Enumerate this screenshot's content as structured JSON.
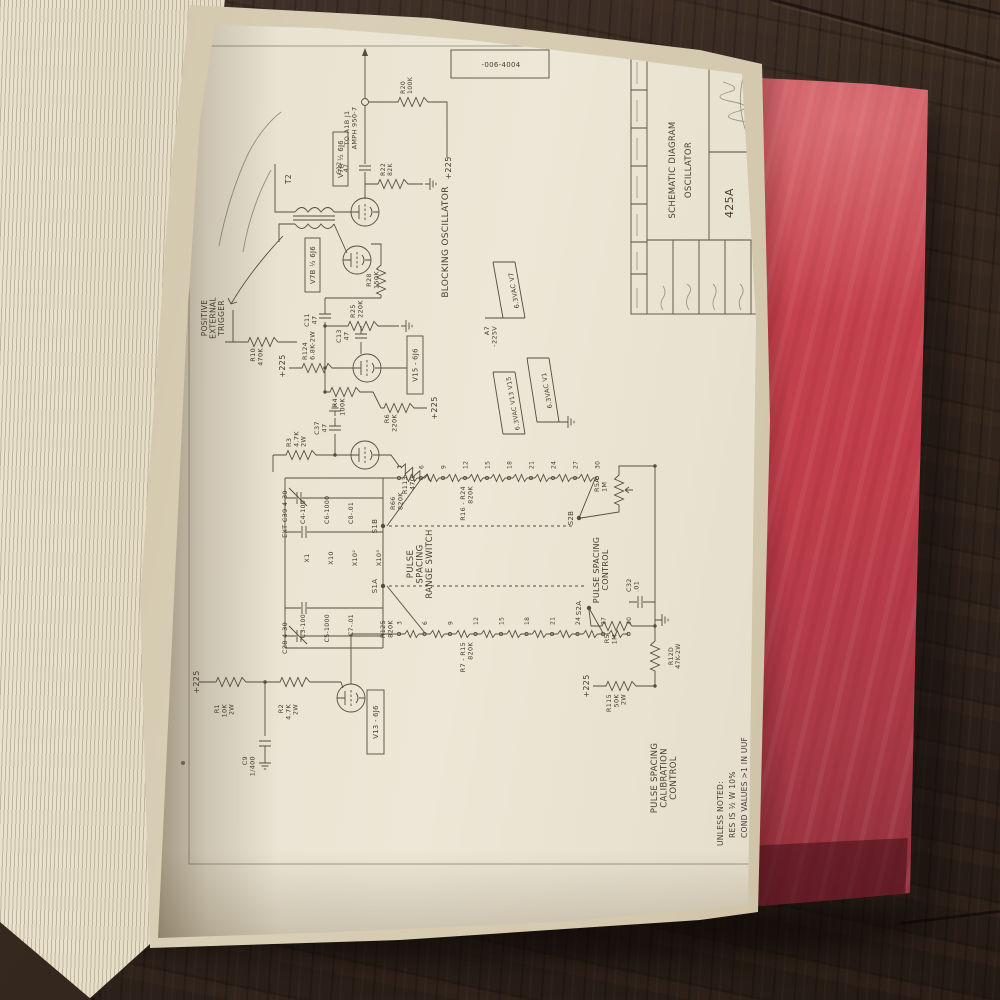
{
  "colors": {
    "cover_red": "#c2414d",
    "page_cream": "#e9e3d2",
    "wood_brown": "#33271e",
    "ink": "#554d40"
  },
  "schematic": {
    "part_number": "-006-4004",
    "title_block": {
      "title_line1": "SCHEMATIC DIAGRAM",
      "title_line2": "OSCILLATOR",
      "model": "425A"
    },
    "notes": [
      "UNLESS NOTED:",
      "RES IS ½ W 10%",
      "COND VALUES >1 IN UUF",
      "COND VALUES <1 IN UF",
      "SEE 425A SOURCE"
    ],
    "range_switch": {
      "contacts": [
        "3",
        "6",
        "9",
        "12",
        "15",
        "18",
        "21",
        "24",
        "27",
        "30"
      ]
    },
    "boxes": [
      {
        "t": "V13 - 6J6",
        "x": 116,
        "y": 182,
        "w": 64,
        "h": 17
      },
      {
        "t": "V15 - 6J6",
        "x": 476,
        "y": 222,
        "w": 58,
        "h": 16
      },
      {
        "t": "V7A ½ 6J6",
        "x": 684,
        "y": 148,
        "w": 54,
        "h": 15
      },
      {
        "t": "V7B ½ 6J6",
        "x": 578,
        "y": 120,
        "w": 54,
        "h": 15
      }
    ],
    "labels": [
      {
        "t": "+225",
        "x": 188,
        "y": 14,
        "s": 8,
        "a": "middle"
      },
      {
        "t": "R1|10K|2W",
        "x": 166,
        "y": 34,
        "s": 6.5,
        "a": "end"
      },
      {
        "t": "R2|4.7K|2W",
        "x": 166,
        "y": 98,
        "s": 6.5,
        "a": "end"
      },
      {
        "t": "C9|1/400",
        "x": 114,
        "y": 62,
        "s": 6.5,
        "a": "end"
      },
      {
        "t": "POSITIVE|EXTERNAL|TRIGGER",
        "x": 552,
        "y": 22,
        "s": 7.5,
        "a": "middle"
      },
      {
        "t": "R10|470K",
        "x": 522,
        "y": 70,
        "s": 6.5,
        "a": "end"
      },
      {
        "t": "+225",
        "x": 504,
        "y": 100,
        "s": 8,
        "a": "middle"
      },
      {
        "t": "R124|6.8K-2W",
        "x": 510,
        "y": 122,
        "s": 6.5
      },
      {
        "t": "C11|47",
        "x": 550,
        "y": 124,
        "s": 6.5,
        "a": "middle"
      },
      {
        "t": "R4|100K",
        "x": 472,
        "y": 152,
        "s": 6.5,
        "a": "end"
      },
      {
        "t": "C13|47",
        "x": 534,
        "y": 156,
        "s": 6.5,
        "a": "middle"
      },
      {
        "t": "R25|220K",
        "x": 552,
        "y": 170,
        "s": 6.5
      },
      {
        "t": "R28|150K",
        "x": 590,
        "y": 186,
        "s": 6.5,
        "a": "middle"
      },
      {
        "t": "R6|220K",
        "x": 456,
        "y": 204,
        "s": 6.5,
        "a": "end"
      },
      {
        "t": "+225",
        "x": 462,
        "y": 252,
        "s": 8,
        "a": "middle"
      },
      {
        "t": "R3|4.7K|2W",
        "x": 423,
        "y": 106,
        "s": 6.5
      },
      {
        "t": "C37|47",
        "x": 442,
        "y": 134,
        "s": 6.5,
        "a": "middle"
      },
      {
        "t": "R113|47Ω",
        "x": 394,
        "y": 222,
        "s": 6.5,
        "a": "end"
      },
      {
        "t": "T2",
        "x": 686,
        "y": 106,
        "s": 7.5
      },
      {
        "t": "+225",
        "x": 702,
        "y": 266,
        "s": 8,
        "a": "middle"
      },
      {
        "t": "C12|47",
        "x": 702,
        "y": 156,
        "s": 6.2,
        "a": "middle"
      },
      {
        "t": "R22|82K",
        "x": 694,
        "y": 200,
        "s": 6.2
      },
      {
        "t": "R20|100K",
        "x": 776,
        "y": 220,
        "s": 6.2
      },
      {
        "t": "TO A1B J1|AMPH 950-7",
        "x": 742,
        "y": 164,
        "s": 6.5,
        "a": "middle"
      },
      {
        "t": "BLOCKING  OSCILLATOR",
        "x": 628,
        "y": 263,
        "s": 9,
        "a": "middle",
        "ls": 1.5
      },
      {
        "t": "A7|-225V",
        "x": 544,
        "y": 304,
        "s": 6.5,
        "a": "end"
      },
      {
        "t": "6.3VAC  V7",
        "x": 580,
        "y": 331,
        "s": 6.5,
        "a": "middle",
        "r": -10
      },
      {
        "t": "6.3VAC  V13  V15",
        "x": 467,
        "y": 330,
        "s": 6.2,
        "a": "middle",
        "r": -10
      },
      {
        "t": "6.3VAC  V1",
        "x": 480,
        "y": 364,
        "s": 6.5,
        "a": "middle",
        "r": -10
      },
      {
        "t": "EXT  C39  4-30",
        "x": 356,
        "y": 102,
        "s": 6.5,
        "a": "middle"
      },
      {
        "t": "C28  4-30",
        "x": 232,
        "y": 102,
        "s": 6.5,
        "a": "middle"
      },
      {
        "t": "X1",
        "x": 312,
        "y": 124,
        "s": 6.5,
        "a": "middle"
      },
      {
        "t": "X10",
        "x": 312,
        "y": 148,
        "s": 6.5,
        "a": "middle"
      },
      {
        "t": "X10²",
        "x": 312,
        "y": 172,
        "s": 6.5,
        "a": "middle"
      },
      {
        "t": "X10³",
        "x": 312,
        "y": 196,
        "s": 6.5,
        "a": "middle"
      },
      {
        "t": "C4-100",
        "x": 346,
        "y": 120,
        "s": 6.2
      },
      {
        "t": "C6-1000",
        "x": 346,
        "y": 144,
        "s": 6.2
      },
      {
        "t": "C8-.01",
        "x": 346,
        "y": 168,
        "s": 6.2
      },
      {
        "t": "S1B",
        "x": 344,
        "y": 192,
        "s": 7,
        "a": "middle"
      },
      {
        "t": "C3-100",
        "x": 256,
        "y": 120,
        "s": 6.2,
        "a": "end"
      },
      {
        "t": "C5-1000",
        "x": 256,
        "y": 144,
        "s": 6.2,
        "a": "end"
      },
      {
        "t": "C7-.01",
        "x": 256,
        "y": 168,
        "s": 6.2,
        "a": "end"
      },
      {
        "t": "S1A",
        "x": 284,
        "y": 192,
        "s": 7,
        "a": "middle"
      },
      {
        "t": "PULSE|SPACING|RANGE  SWITCH",
        "x": 306,
        "y": 228,
        "s": 8.5,
        "a": "middle"
      },
      {
        "t": "R66|820K",
        "x": 360,
        "y": 210,
        "s": 6.5
      },
      {
        "t": "R125|820K",
        "x": 250,
        "y": 200,
        "s": 6.5,
        "a": "end"
      },
      {
        "t": "R16 - R24|820K",
        "x": 384,
        "y": 280,
        "s": 6.5,
        "a": "end"
      },
      {
        "t": "R7 - R15|820K",
        "x": 228,
        "y": 280,
        "s": 6.5,
        "a": "end"
      },
      {
        "t": "S2B",
        "x": 352,
        "y": 388,
        "s": 7,
        "a": "middle"
      },
      {
        "t": "S2A",
        "x": 262,
        "y": 396,
        "s": 7,
        "a": "middle"
      },
      {
        "t": "PULSE  SPACING|CONTROL",
        "x": 300,
        "y": 414,
        "s": 8,
        "a": "middle"
      },
      {
        "t": "R5A|1M",
        "x": 378,
        "y": 414,
        "s": 6.5
      },
      {
        "t": "R5|1M",
        "x": 236,
        "y": 424,
        "s": 6.5,
        "a": "end"
      },
      {
        "t": "C32|.01",
        "x": 278,
        "y": 446,
        "s": 6.5
      },
      {
        "t": "+225",
        "x": 184,
        "y": 404,
        "s": 8,
        "a": "middle"
      },
      {
        "t": "R115|50K|2W",
        "x": 176,
        "y": 426,
        "s": 6.5,
        "a": "end"
      },
      {
        "t": "R12D|47K-2W",
        "x": 214,
        "y": 488,
        "s": 6.2,
        "a": "middle"
      },
      {
        "t": "PULSE  SPACING|CALIBRATION|CONTROL",
        "x": 92,
        "y": 472,
        "s": 8.5,
        "a": "middle"
      }
    ]
  }
}
